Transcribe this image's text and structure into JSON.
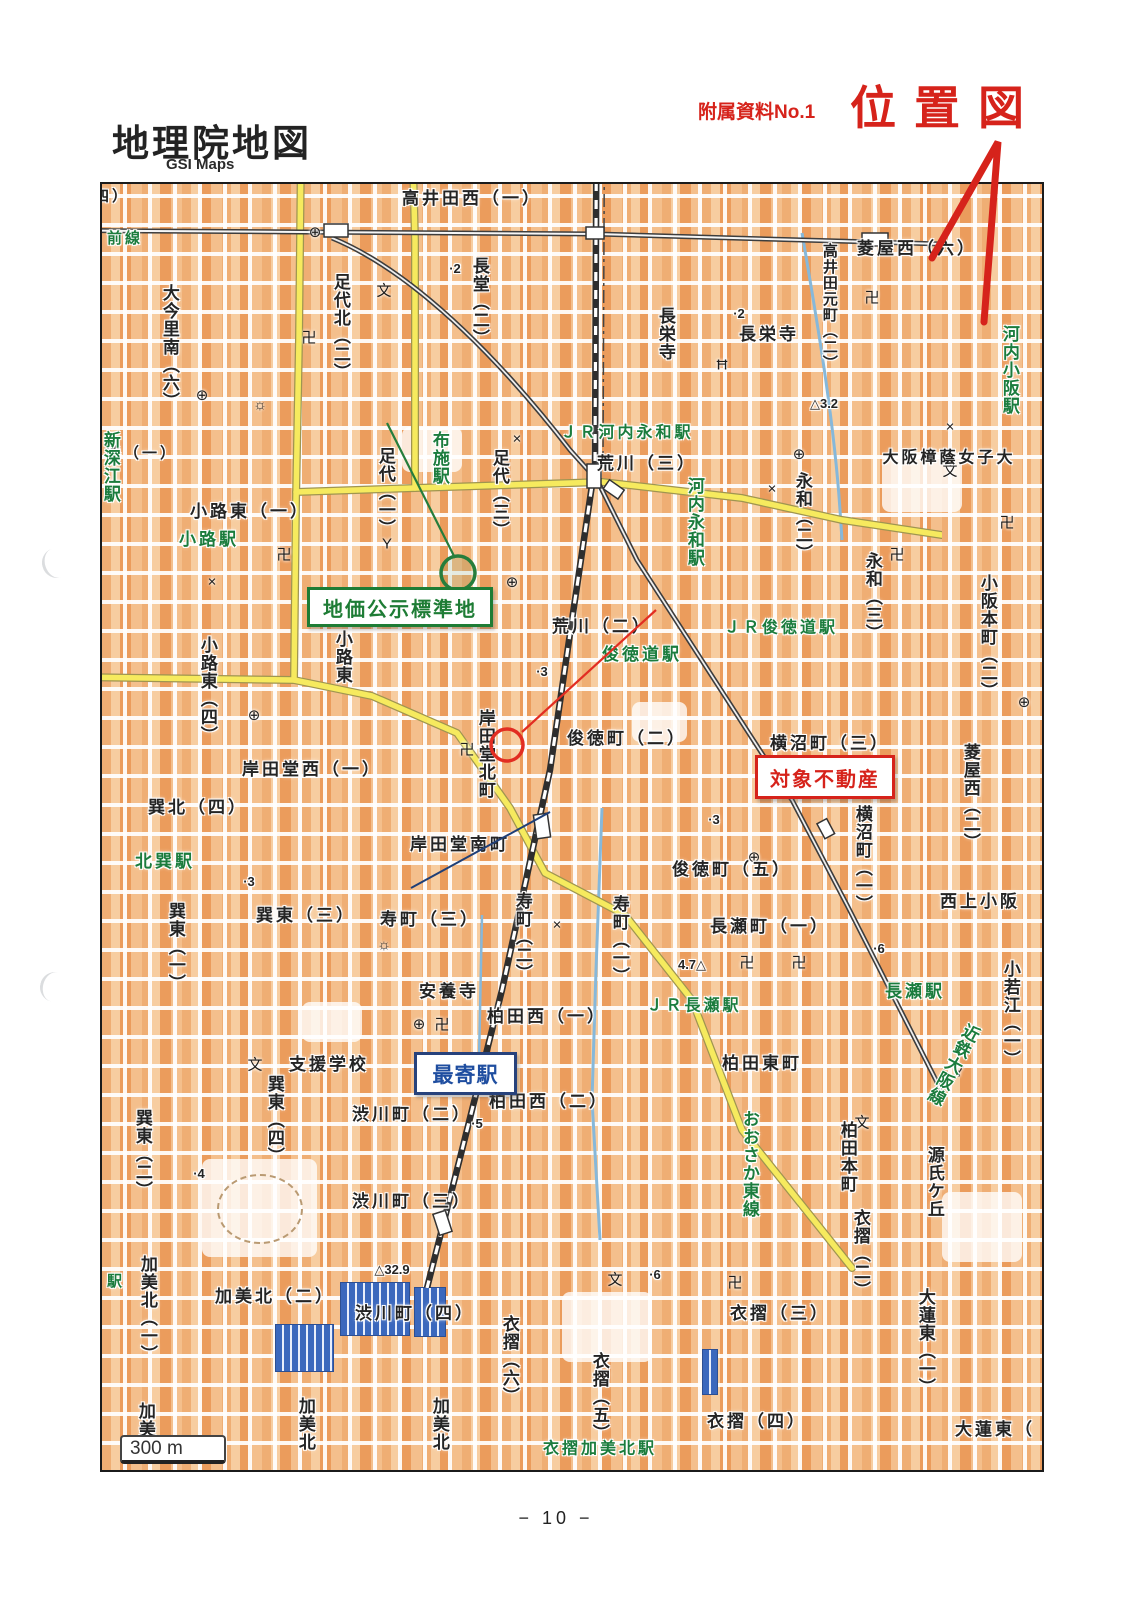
{
  "header": {
    "title": "地理院地図",
    "subtitle": "GSI Maps",
    "doc_ref": "附属資料No.1",
    "doc_title": "位置図"
  },
  "footer": {
    "page_number": "− 10 −"
  },
  "annotations": {
    "standard_site": {
      "label": "地価公示標準地",
      "color": "#1e7c35"
    },
    "subject_property": {
      "label": "対象不動産",
      "color": "#d6231b"
    },
    "nearest_station": {
      "label": "最寄駅",
      "color": "#1f4ea0"
    }
  },
  "colors": {
    "accent_red": "#d6231b",
    "station_green": "#1b7c3d",
    "road_yellow": "#f6ea5e",
    "road_red": "#db8e84",
    "building_orange": "#efae74",
    "factory_blue": "#3b68bd"
  },
  "map": {
    "scale_label": "300 m",
    "route_shield": "479",
    "labels": [
      {
        "t": "四）",
        "x": 110,
        "y": 195,
        "d": "h",
        "c": "k",
        "s": 15
      },
      {
        "t": "高井田西（一）",
        "x": 470,
        "y": 197,
        "d": "h",
        "c": "k"
      },
      {
        "t": "菱屋西（六）",
        "x": 915,
        "y": 247,
        "d": "h",
        "c": "k"
      },
      {
        "t": "長栄寺",
        "x": 767,
        "y": 333,
        "d": "h",
        "c": "k"
      },
      {
        "t": "荒川（三）",
        "x": 645,
        "y": 462,
        "d": "h",
        "c": "k"
      },
      {
        "t": "大阪樟蔭女子大",
        "x": 947,
        "y": 457,
        "d": "h",
        "c": "k",
        "s": 16
      },
      {
        "t": "路（一）",
        "x": 140,
        "y": 452,
        "d": "h",
        "c": "k",
        "s": 15
      },
      {
        "t": "小路東（一）",
        "x": 248,
        "y": 510,
        "d": "h",
        "c": "k"
      },
      {
        "t": "荒川（二）",
        "x": 600,
        "y": 625,
        "d": "h",
        "c": "k"
      },
      {
        "t": "俊徳町（二）",
        "x": 625,
        "y": 737,
        "d": "h",
        "c": "k"
      },
      {
        "t": "横沼町（三）",
        "x": 828,
        "y": 742,
        "d": "h",
        "c": "k"
      },
      {
        "t": "岸田堂西（一）",
        "x": 310,
        "y": 768,
        "d": "h",
        "c": "k"
      },
      {
        "t": "巽北（四）",
        "x": 196,
        "y": 806,
        "d": "h",
        "c": "k"
      },
      {
        "t": "岸田堂南町",
        "x": 458,
        "y": 843,
        "d": "h",
        "c": "k"
      },
      {
        "t": "俊徳町（五）",
        "x": 730,
        "y": 868,
        "d": "h",
        "c": "k"
      },
      {
        "t": "寿町（三）",
        "x": 428,
        "y": 918,
        "d": "h",
        "c": "k"
      },
      {
        "t": "長瀬町（一）",
        "x": 768,
        "y": 925,
        "d": "h",
        "c": "k"
      },
      {
        "t": "西上小阪",
        "x": 978,
        "y": 900,
        "d": "h",
        "c": "k"
      },
      {
        "t": "巽東（三）",
        "x": 304,
        "y": 914,
        "d": "h",
        "c": "k"
      },
      {
        "t": "安養寺",
        "x": 447,
        "y": 990,
        "d": "h",
        "c": "k"
      },
      {
        "t": "柏田西（一）",
        "x": 545,
        "y": 1015,
        "d": "h",
        "c": "k"
      },
      {
        "t": "支援学校",
        "x": 327,
        "y": 1063,
        "d": "h",
        "c": "k"
      },
      {
        "t": "柏田東町",
        "x": 760,
        "y": 1062,
        "d": "h",
        "c": "k"
      },
      {
        "t": "柏田西（二）",
        "x": 547,
        "y": 1100,
        "d": "h",
        "c": "k"
      },
      {
        "t": "渋川町（二）",
        "x": 410,
        "y": 1113,
        "d": "h",
        "c": "k"
      },
      {
        "t": "渋川町（三）",
        "x": 410,
        "y": 1200,
        "d": "h",
        "c": "k"
      },
      {
        "t": "加美北（二）",
        "x": 273,
        "y": 1295,
        "d": "h",
        "c": "k"
      },
      {
        "t": "渋川町（四）",
        "x": 413,
        "y": 1312,
        "d": "h",
        "c": "k"
      },
      {
        "t": "衣摺（三）",
        "x": 778,
        "y": 1312,
        "d": "h",
        "c": "k"
      },
      {
        "t": "衣摺（四）",
        "x": 755,
        "y": 1420,
        "d": "h",
        "c": "k"
      },
      {
        "t": "大蓮東（",
        "x": 993,
        "y": 1428,
        "d": "h",
        "c": "k"
      },
      {
        "t": "大今里南（六）",
        "x": 167,
        "y": 345,
        "d": "v",
        "c": "k"
      },
      {
        "t": "足代北（二）",
        "x": 338,
        "y": 325,
        "d": "v",
        "c": "k"
      },
      {
        "t": "長堂（二）",
        "x": 477,
        "y": 300,
        "d": "v",
        "c": "k"
      },
      {
        "t": "高井田元町（二）",
        "x": 827,
        "y": 305,
        "d": "v",
        "c": "k",
        "s": 15
      },
      {
        "t": "長栄寺",
        "x": 663,
        "y": 332,
        "d": "v",
        "c": "k"
      },
      {
        "t": "足代（一）",
        "x": 383,
        "y": 490,
        "d": "v",
        "c": "k"
      },
      {
        "t": "足代（三）",
        "x": 497,
        "y": 492,
        "d": "v",
        "c": "k"
      },
      {
        "t": "永和（二）",
        "x": 800,
        "y": 515,
        "d": "v",
        "c": "k"
      },
      {
        "t": "永和（三）",
        "x": 870,
        "y": 595,
        "d": "v",
        "c": "k"
      },
      {
        "t": "小阪本町（二）",
        "x": 985,
        "y": 635,
        "d": "v",
        "c": "k"
      },
      {
        "t": "菱屋西（二）",
        "x": 968,
        "y": 795,
        "d": "v",
        "c": "k"
      },
      {
        "t": "小路東（四）",
        "x": 205,
        "y": 688,
        "d": "v",
        "c": "k"
      },
      {
        "t": "小路東",
        "x": 340,
        "y": 655,
        "d": "v",
        "c": "k"
      },
      {
        "t": "岸田堂北町",
        "x": 483,
        "y": 752,
        "d": "v",
        "c": "k"
      },
      {
        "t": "横沼町（一）",
        "x": 860,
        "y": 857,
        "d": "v",
        "c": "k"
      },
      {
        "t": "寿町（二）",
        "x": 520,
        "y": 935,
        "d": "v",
        "c": "k"
      },
      {
        "t": "寿町（一）",
        "x": 617,
        "y": 938,
        "d": "v",
        "c": "k"
      },
      {
        "t": "巽東（一）",
        "x": 173,
        "y": 945,
        "d": "v",
        "c": "k"
      },
      {
        "t": "巽東（二）",
        "x": 140,
        "y": 1152,
        "d": "v",
        "c": "k"
      },
      {
        "t": "巽東（四）",
        "x": 272,
        "y": 1118,
        "d": "v",
        "c": "k"
      },
      {
        "t": "柏田本町",
        "x": 845,
        "y": 1155,
        "d": "v",
        "c": "k"
      },
      {
        "t": "小若江（一）",
        "x": 1008,
        "y": 1012,
        "d": "v",
        "c": "k"
      },
      {
        "t": "源氏ケ丘",
        "x": 932,
        "y": 1180,
        "d": "v",
        "c": "k"
      },
      {
        "t": "大蓮東（一）",
        "x": 923,
        "y": 1340,
        "d": "v",
        "c": "k"
      },
      {
        "t": "衣摺（二）",
        "x": 858,
        "y": 1252,
        "d": "v",
        "c": "k"
      },
      {
        "t": "衣摺（六）",
        "x": 507,
        "y": 1358,
        "d": "v",
        "c": "k"
      },
      {
        "t": "衣摺（五）",
        "x": 597,
        "y": 1395,
        "d": "v",
        "c": "k"
      },
      {
        "t": "加美北（一）",
        "x": 145,
        "y": 1307,
        "d": "v",
        "c": "k"
      },
      {
        "t": "加美",
        "x": 143,
        "y": 1418,
        "d": "v",
        "c": "k"
      },
      {
        "t": "加美北",
        "x": 303,
        "y": 1422,
        "d": "v",
        "c": "k"
      },
      {
        "t": "加美北",
        "x": 437,
        "y": 1422,
        "d": "v",
        "c": "k"
      },
      {
        "t": "ＪＲ河内永和駅",
        "x": 625,
        "y": 432,
        "d": "h",
        "c": "g",
        "s": 16
      },
      {
        "t": "俊徳道駅",
        "x": 640,
        "y": 653,
        "d": "h",
        "c": "g"
      },
      {
        "t": "ＪＲ俊徳道駅",
        "x": 779,
        "y": 627,
        "d": "h",
        "c": "g",
        "s": 16
      },
      {
        "t": "小路駅",
        "x": 207,
        "y": 538,
        "d": "h",
        "c": "g"
      },
      {
        "t": "北巽駅",
        "x": 163,
        "y": 860,
        "d": "h",
        "c": "g"
      },
      {
        "t": "ＪＲ長瀬駅",
        "x": 692,
        "y": 1005,
        "d": "h",
        "c": "g",
        "s": 16
      },
      {
        "t": "長瀬駅",
        "x": 913,
        "y": 990,
        "d": "h",
        "c": "g"
      },
      {
        "t": "衣摺加美北駅",
        "x": 598,
        "y": 1448,
        "d": "h",
        "c": "g",
        "s": 16
      },
      {
        "t": "前線",
        "x": 123,
        "y": 237,
        "d": "h",
        "c": "g",
        "s": 15
      },
      {
        "t": "駅",
        "x": 114,
        "y": 1280,
        "d": "h",
        "c": "g",
        "s": 15
      },
      {
        "t": "河内永和駅",
        "x": 692,
        "y": 520,
        "d": "v",
        "c": "g"
      },
      {
        "t": "布施駅",
        "x": 437,
        "y": 456,
        "d": "v",
        "c": "g"
      },
      {
        "t": "河内小阪駅",
        "x": 1007,
        "y": 368,
        "d": "v",
        "c": "g"
      },
      {
        "t": "新深江駅",
        "x": 108,
        "y": 465,
        "d": "v",
        "c": "g"
      },
      {
        "t": "おおさか東線",
        "x": 747,
        "y": 1162,
        "d": "v",
        "c": "g"
      },
      {
        "t": "近鉄大阪線",
        "x": 950,
        "y": 1062,
        "d": "v",
        "c": "g",
        "r": 28
      }
    ],
    "spots": [
      {
        "t": "·2",
        "x": 453,
        "y": 267
      },
      {
        "t": "·2",
        "x": 737,
        "y": 312
      },
      {
        "t": "△3.2",
        "x": 822,
        "y": 402
      },
      {
        "t": "·3",
        "x": 540,
        "y": 670
      },
      {
        "t": "·3",
        "x": 712,
        "y": 818
      },
      {
        "t": "·3",
        "x": 247,
        "y": 880
      },
      {
        "t": "·6",
        "x": 877,
        "y": 947
      },
      {
        "t": "4.7△",
        "x": 690,
        "y": 963
      },
      {
        "t": "·5",
        "x": 475,
        "y": 1122
      },
      {
        "t": "·4",
        "x": 197,
        "y": 1172
      },
      {
        "t": "△32.9",
        "x": 390,
        "y": 1268
      },
      {
        "t": "·6",
        "x": 653,
        "y": 1273
      }
    ],
    "symbols": [
      {
        "g": "卍",
        "x": 307,
        "y": 335
      },
      {
        "g": "卍",
        "x": 870,
        "y": 295
      },
      {
        "g": "卍",
        "x": 282,
        "y": 552
      },
      {
        "g": "卍",
        "x": 895,
        "y": 552
      },
      {
        "g": "卍",
        "x": 465,
        "y": 747
      },
      {
        "g": "卍",
        "x": 745,
        "y": 960
      },
      {
        "g": "卍",
        "x": 797,
        "y": 960
      },
      {
        "g": "卍",
        "x": 440,
        "y": 1022
      },
      {
        "g": "卍",
        "x": 733,
        "y": 1280
      },
      {
        "g": "卍",
        "x": 1005,
        "y": 520
      },
      {
        "g": "⊕",
        "x": 313,
        "y": 230
      },
      {
        "g": "⊕",
        "x": 200,
        "y": 393
      },
      {
        "g": "⊕",
        "x": 510,
        "y": 580
      },
      {
        "g": "⊕",
        "x": 797,
        "y": 452
      },
      {
        "g": "⊕",
        "x": 752,
        "y": 855
      },
      {
        "g": "⊕",
        "x": 252,
        "y": 713
      },
      {
        "g": "⊕",
        "x": 417,
        "y": 1022
      },
      {
        "g": "⊕",
        "x": 1022,
        "y": 700
      },
      {
        "g": "文",
        "x": 382,
        "y": 288
      },
      {
        "g": "文",
        "x": 948,
        "y": 468
      },
      {
        "g": "文",
        "x": 253,
        "y": 1062
      },
      {
        "g": "文",
        "x": 613,
        "y": 1277
      },
      {
        "g": "文",
        "x": 860,
        "y": 1120
      },
      {
        "g": "×",
        "x": 210,
        "y": 580
      },
      {
        "g": "×",
        "x": 770,
        "y": 487
      },
      {
        "g": "×",
        "x": 555,
        "y": 923
      },
      {
        "g": "×",
        "x": 948,
        "y": 425
      },
      {
        "g": "×",
        "x": 515,
        "y": 437
      },
      {
        "g": "Y",
        "x": 385,
        "y": 542
      },
      {
        "g": "Y",
        "x": 957,
        "y": 1070
      },
      {
        "g": "☼",
        "x": 258,
        "y": 403
      },
      {
        "g": "☼",
        "x": 382,
        "y": 943
      },
      {
        "g": "Ħ",
        "x": 720,
        "y": 363
      }
    ]
  }
}
